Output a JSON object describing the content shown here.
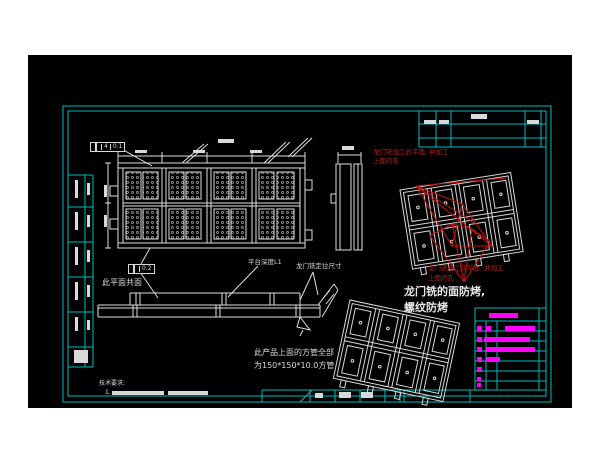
{
  "colors": {
    "background": "#ffffff",
    "canvas": "#000000",
    "frame": "#00bcbc",
    "line": "#dedede",
    "red_line": "#cc1010",
    "red_text": "#b42222",
    "magenta": "#ff00ff",
    "white_text": "#e8e8e8"
  },
  "labels": {
    "red_note_top_line1": "龙门铣加工此平面, 并加工",
    "red_note_top_line2": "上面的孔",
    "red_note_bottom_line1": "龙门铣加工此平面, 并加工",
    "red_note_bottom_line2": "上面的孔",
    "bake_note_line1": "龙门铣的面防烤,",
    "bake_note_line2": "螺纹防烤",
    "coplanar_note": "此平面共面",
    "platform_note": "平台深度L1",
    "gantry_locate_note": "龙门铣定位尺寸",
    "tube_note_line1": "此产品上面的方管全部",
    "tube_note_line2": "为150*150*10.0方管",
    "tech_req_title": "技术要求:",
    "tech_req_item_no": "1."
  },
  "fcf": {
    "top_count": "4",
    "top_tolerance": "0.1",
    "bottom_tolerance": "0.2"
  },
  "placeholder_marks": {
    "white": [
      [
        424,
        120,
        12,
        4
      ],
      [
        439,
        120,
        10,
        4
      ],
      [
        471,
        114,
        16,
        5
      ],
      [
        527,
        120,
        12,
        4
      ],
      [
        135,
        150,
        12,
        3
      ],
      [
        193,
        150,
        12,
        3
      ],
      [
        250,
        150,
        12,
        3
      ],
      [
        218,
        139,
        16,
        4
      ],
      [
        104,
        185,
        3,
        12
      ],
      [
        104,
        215,
        3,
        12
      ],
      [
        342,
        146,
        12,
        4
      ],
      [
        75,
        180,
        3,
        18
      ],
      [
        87,
        183,
        3,
        12
      ],
      [
        75,
        212,
        3,
        18
      ],
      [
        87,
        215,
        3,
        12
      ],
      [
        75,
        247,
        3,
        18
      ],
      [
        87,
        250,
        3,
        12
      ],
      [
        75,
        282,
        3,
        18
      ],
      [
        87,
        285,
        3,
        12
      ],
      [
        75,
        317,
        3,
        14
      ],
      [
        87,
        320,
        3,
        10
      ],
      [
        74,
        350,
        14,
        13
      ],
      [
        339,
        392,
        12,
        6
      ],
      [
        361,
        392,
        12,
        6
      ],
      [
        315,
        393,
        8,
        5
      ],
      [
        112,
        391,
        52,
        4
      ],
      [
        168,
        391,
        40,
        4
      ]
    ],
    "magenta": [
      [
        489,
        313,
        29,
        5
      ],
      [
        477,
        326,
        5,
        5
      ],
      [
        486,
        326,
        5,
        5
      ],
      [
        505,
        326,
        30,
        5
      ],
      [
        477,
        337,
        5,
        5
      ],
      [
        484,
        337,
        46,
        5
      ],
      [
        477,
        347,
        5,
        5
      ],
      [
        486,
        347,
        49,
        5
      ],
      [
        477,
        357,
        5,
        5
      ],
      [
        486,
        357,
        14,
        5
      ],
      [
        477,
        367,
        5,
        5
      ],
      [
        477,
        377,
        4,
        4
      ],
      [
        477,
        383,
        4,
        4
      ]
    ]
  }
}
